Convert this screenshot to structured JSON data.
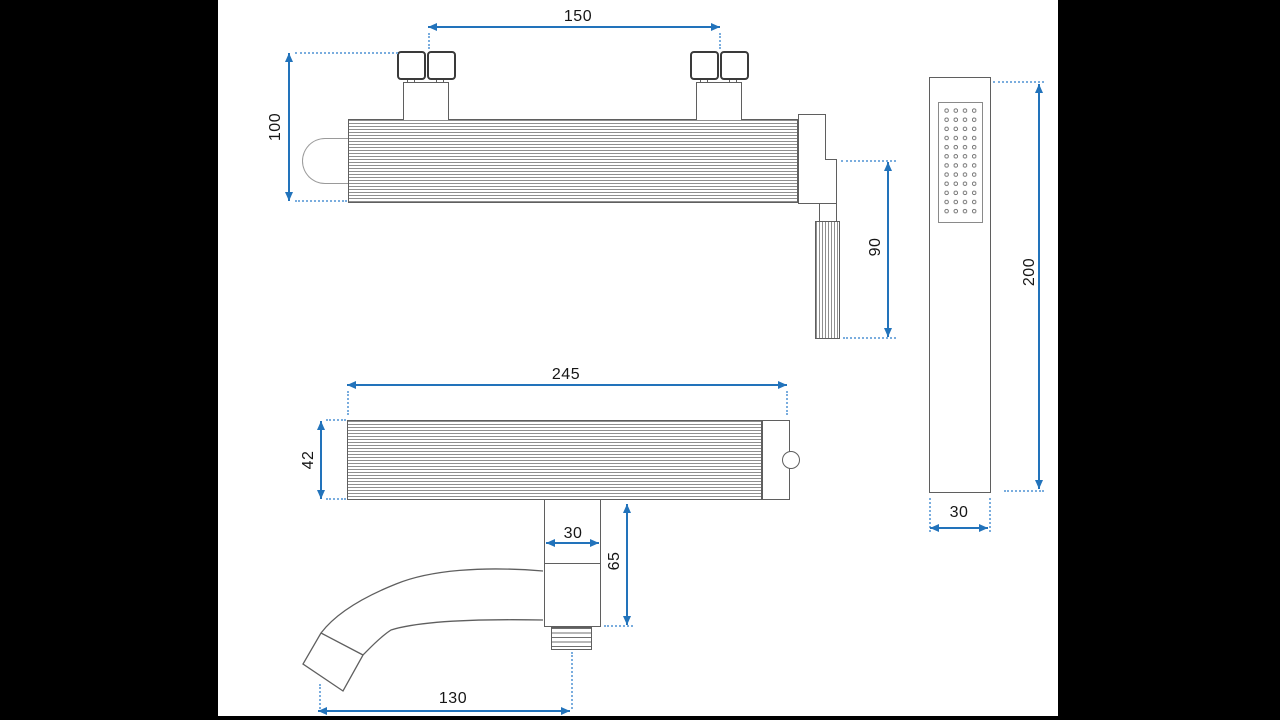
{
  "document": {
    "type": "technical-dimension-drawing",
    "subject": "wall-mounted bath shower mixer with hand shower",
    "unit": "mm"
  },
  "colors": {
    "dimension": "#2273bb",
    "leader": "#7aadde",
    "outline": "#5f5f5f",
    "matte": "#000000",
    "background": "#ffffff"
  },
  "views": {
    "front": {
      "name": "front view",
      "dimensions": {
        "inlet_spacing": "150",
        "body_height": "100",
        "handle_length": "90"
      }
    },
    "top": {
      "name": "top view with spout",
      "dimensions": {
        "body_width": "245",
        "body_depth": "42",
        "spout_offset": "30",
        "spout_drop": "65",
        "spout_reach": "130"
      }
    },
    "handshower": {
      "name": "hand shower",
      "dimensions": {
        "length": "200",
        "width": "30"
      }
    }
  }
}
